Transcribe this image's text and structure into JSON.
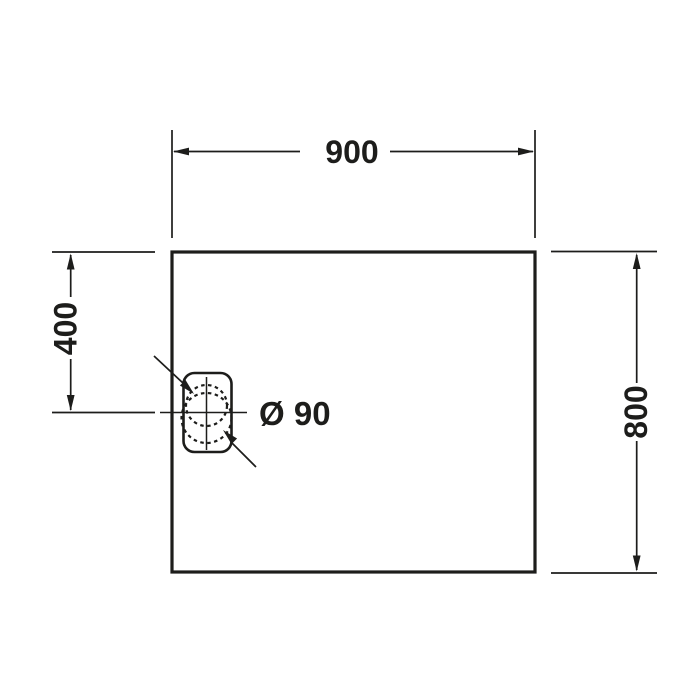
{
  "drawing": {
    "background_color": "#ffffff",
    "line_color": "#1d1d1b",
    "subject": "rectangular shower tray plan view with offset drain",
    "labels": {
      "width": "900",
      "height": "800",
      "drain_offset": "400",
      "drain_diameter": "Ø 90"
    },
    "values": {
      "width_mm": 900,
      "height_mm": 800,
      "drain_offset_mm": 400,
      "drain_diameter_mm": 90
    }
  }
}
